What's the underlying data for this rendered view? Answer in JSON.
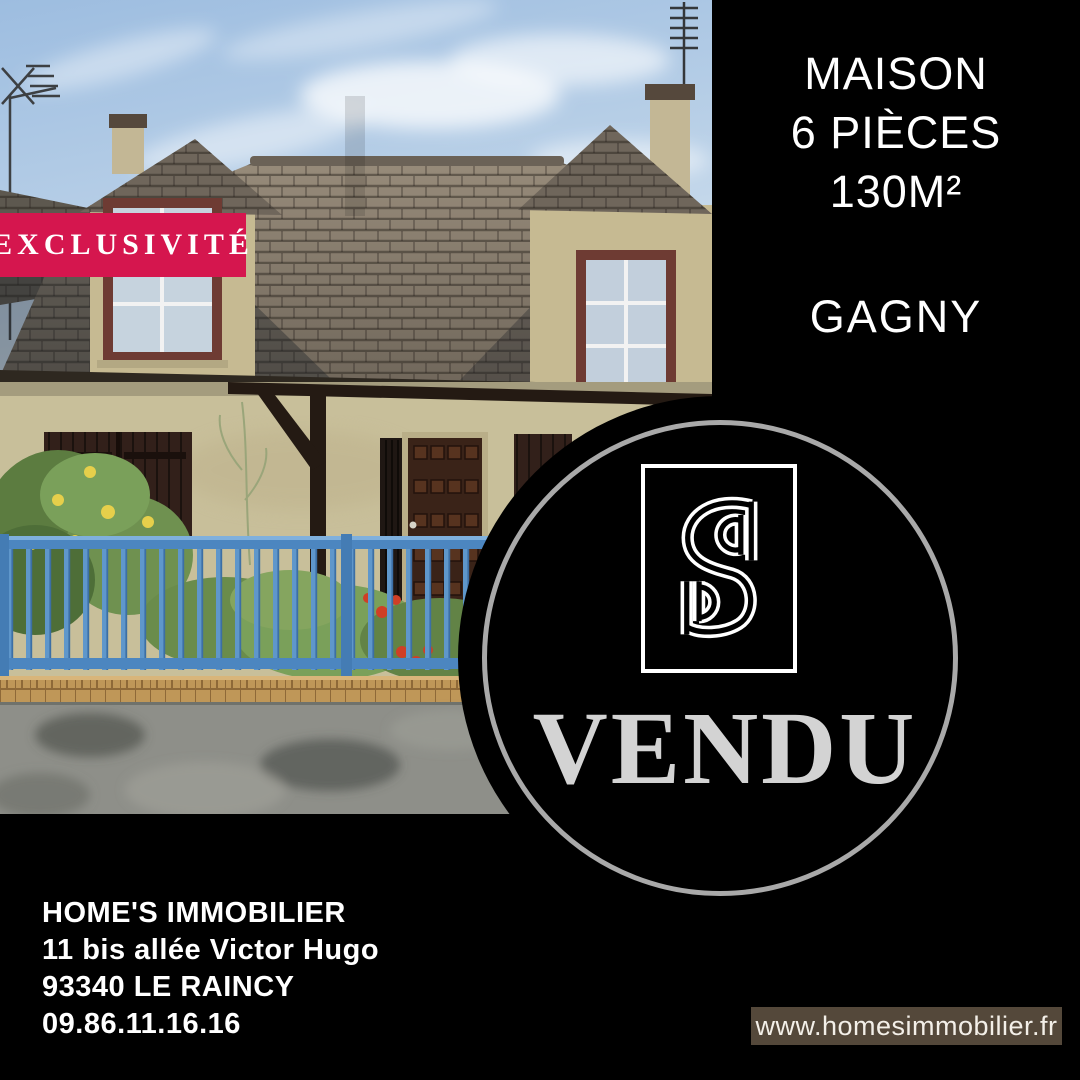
{
  "badge": {
    "label": "EXCLUSIVITÉ",
    "bg_color": "#d5164e"
  },
  "listing": {
    "type": "MAISON",
    "rooms": "6 PIÈCES",
    "area": "130M²",
    "city": "GAGNY"
  },
  "status": {
    "label": "VENDU"
  },
  "logo": {
    "icon": "sd-monogram-icon"
  },
  "agency": {
    "name": "HOME'S IMMOBILIER",
    "address_line1": "11 bis allée Victor Hugo",
    "address_line2": "93340 LE RAINCY",
    "phone": "09.86.11.16.16",
    "website": "www.homesimmobilier.fr"
  },
  "colors": {
    "badge_red": "#d5164e",
    "stamp_ring_silver": "#a9a9a9",
    "vendu_gray": "#d3d3d3",
    "webbar_brown": "#54483a",
    "fence_blue": "#4c86c0"
  }
}
